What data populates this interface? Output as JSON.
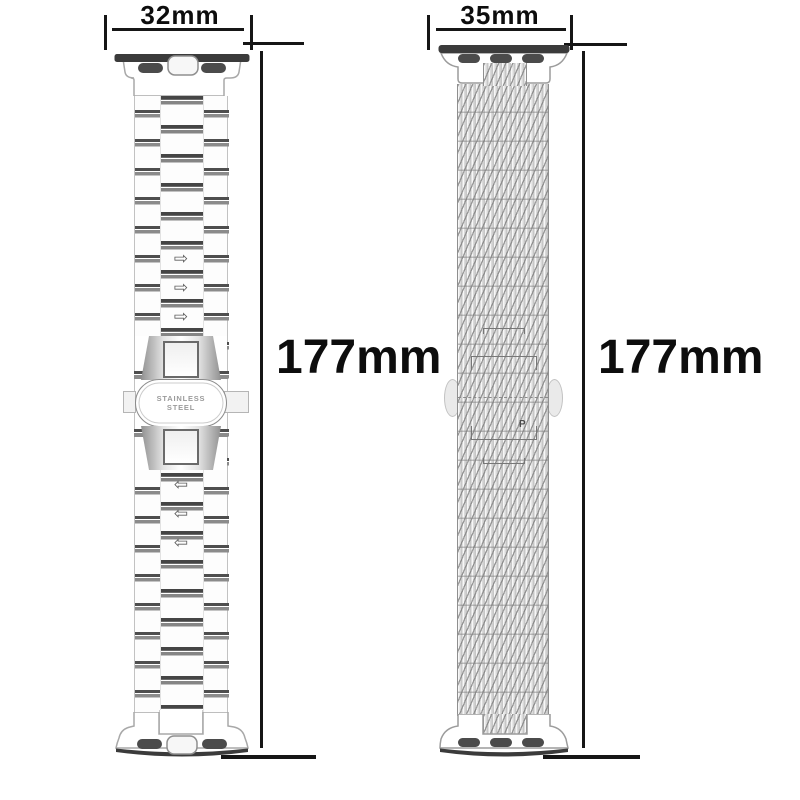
{
  "left_band": {
    "width_label": "32mm",
    "length_label": "177mm",
    "clasp_engraving": {
      "line1": "STAINLESS",
      "line2": "STEEL"
    },
    "upper_arrow_symbol": "⇨",
    "lower_arrow_symbol": "⇦"
  },
  "right_band": {
    "width_label": "35mm",
    "length_label": "177mm",
    "mesh_mark": "P"
  },
  "colors": {
    "ink": "#161616",
    "connector_bar": "#3b3b3b",
    "connector_slot": "#4b4b4b",
    "link_dark": "#4e4e4e",
    "link_mid": "#8b8b8b",
    "outline_gray": "#9c9c9c",
    "engraving_gray": "#9a9a9a",
    "mesh_base": "#efefef"
  }
}
